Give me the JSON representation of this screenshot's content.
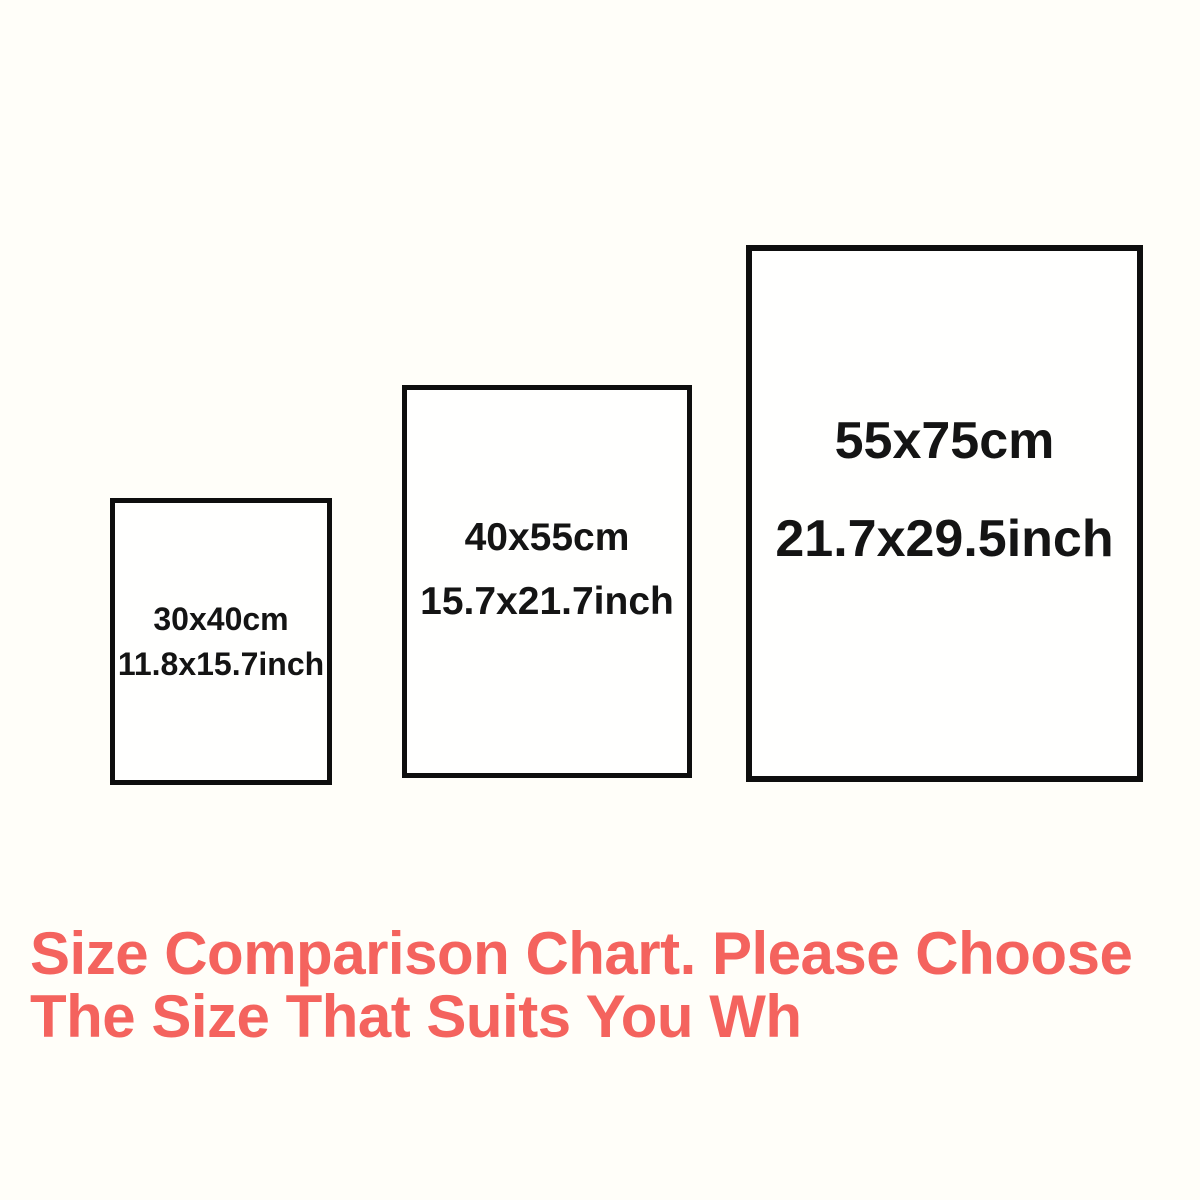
{
  "palette": {
    "background": "#FFFEF9",
    "box_border": "#0E0E0E",
    "box_text": "#141414",
    "caption_text": "#F4635E"
  },
  "boxes": [
    {
      "name": "small",
      "cm": "30x40cm",
      "inch": "11.8x15.7inch"
    },
    {
      "name": "medium",
      "cm": "40x55cm",
      "inch": "15.7x21.7inch"
    },
    {
      "name": "large",
      "cm": "55x75cm",
      "inch": "21.7x29.5inch"
    }
  ],
  "caption": {
    "line1": "Size Comparison Chart. Please Choose",
    "line2": "The Size That Suits You Wh"
  }
}
